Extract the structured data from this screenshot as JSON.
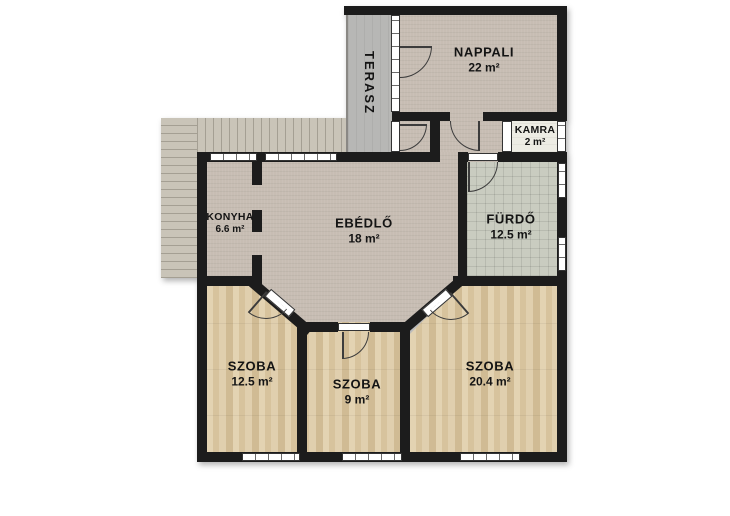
{
  "floorplan": {
    "title": "floor-plan",
    "rooms": [
      {
        "id": "terasz",
        "name": "TERASZ",
        "area": ""
      },
      {
        "id": "nappali",
        "name": "NAPPALI",
        "area": "22 m²"
      },
      {
        "id": "kamra",
        "name": "KAMRA",
        "area": "2 m²"
      },
      {
        "id": "konyha",
        "name": "KONYHA",
        "area": "6.6 m²"
      },
      {
        "id": "ebedlo",
        "name": "EBÉDLŐ",
        "area": "18 m²"
      },
      {
        "id": "furdo",
        "name": "FÜRDŐ",
        "area": "12.5 m²"
      },
      {
        "id": "szoba1",
        "name": "SZOBA",
        "area": "12.5 m²"
      },
      {
        "id": "szoba2",
        "name": "SZOBA",
        "area": "9 m²"
      },
      {
        "id": "szoba3",
        "name": "SZOBA",
        "area": "20.4 m²"
      }
    ],
    "colors": {
      "wall": "#1c1c1c",
      "carpet": "#c7bdb3",
      "wood": "#ddcaa6",
      "tile": "#c9ccc0",
      "terrace": "#b7b7b5",
      "pantry": "#edece4",
      "deck": "#c9c4b8",
      "deck_line": "#a49f93",
      "window_fill": "#ffffff"
    }
  }
}
